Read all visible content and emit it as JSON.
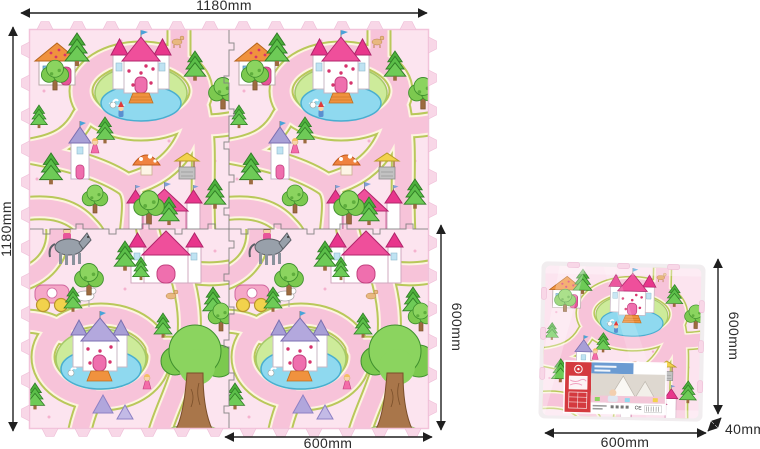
{
  "diagram": {
    "labels": {
      "mat_width": "1180mm",
      "mat_height": "1180mm",
      "tile_height": "600mm",
      "tile_width": "600mm",
      "pkg_height": "600mm",
      "pkg_width": "600mm",
      "pkg_thickness": "40mm",
      "ce_mark": "CE"
    },
    "colors": {
      "background": "#ffffff",
      "mat_pink": "#fce4ef",
      "road_pink": "#f7c3d9",
      "road_edge_olive": "#b9c85a",
      "grass_green": "#cdeb9a",
      "pond_blue": "#8fd9ef",
      "tree_green": "#6ecb57",
      "castle_rose": "#e8368c",
      "castle_lavender": "#a89fd6",
      "roof_orange": "#f0923e",
      "label_red": "#d43a3f",
      "dimension_line": "#1f1f1f"
    }
  }
}
